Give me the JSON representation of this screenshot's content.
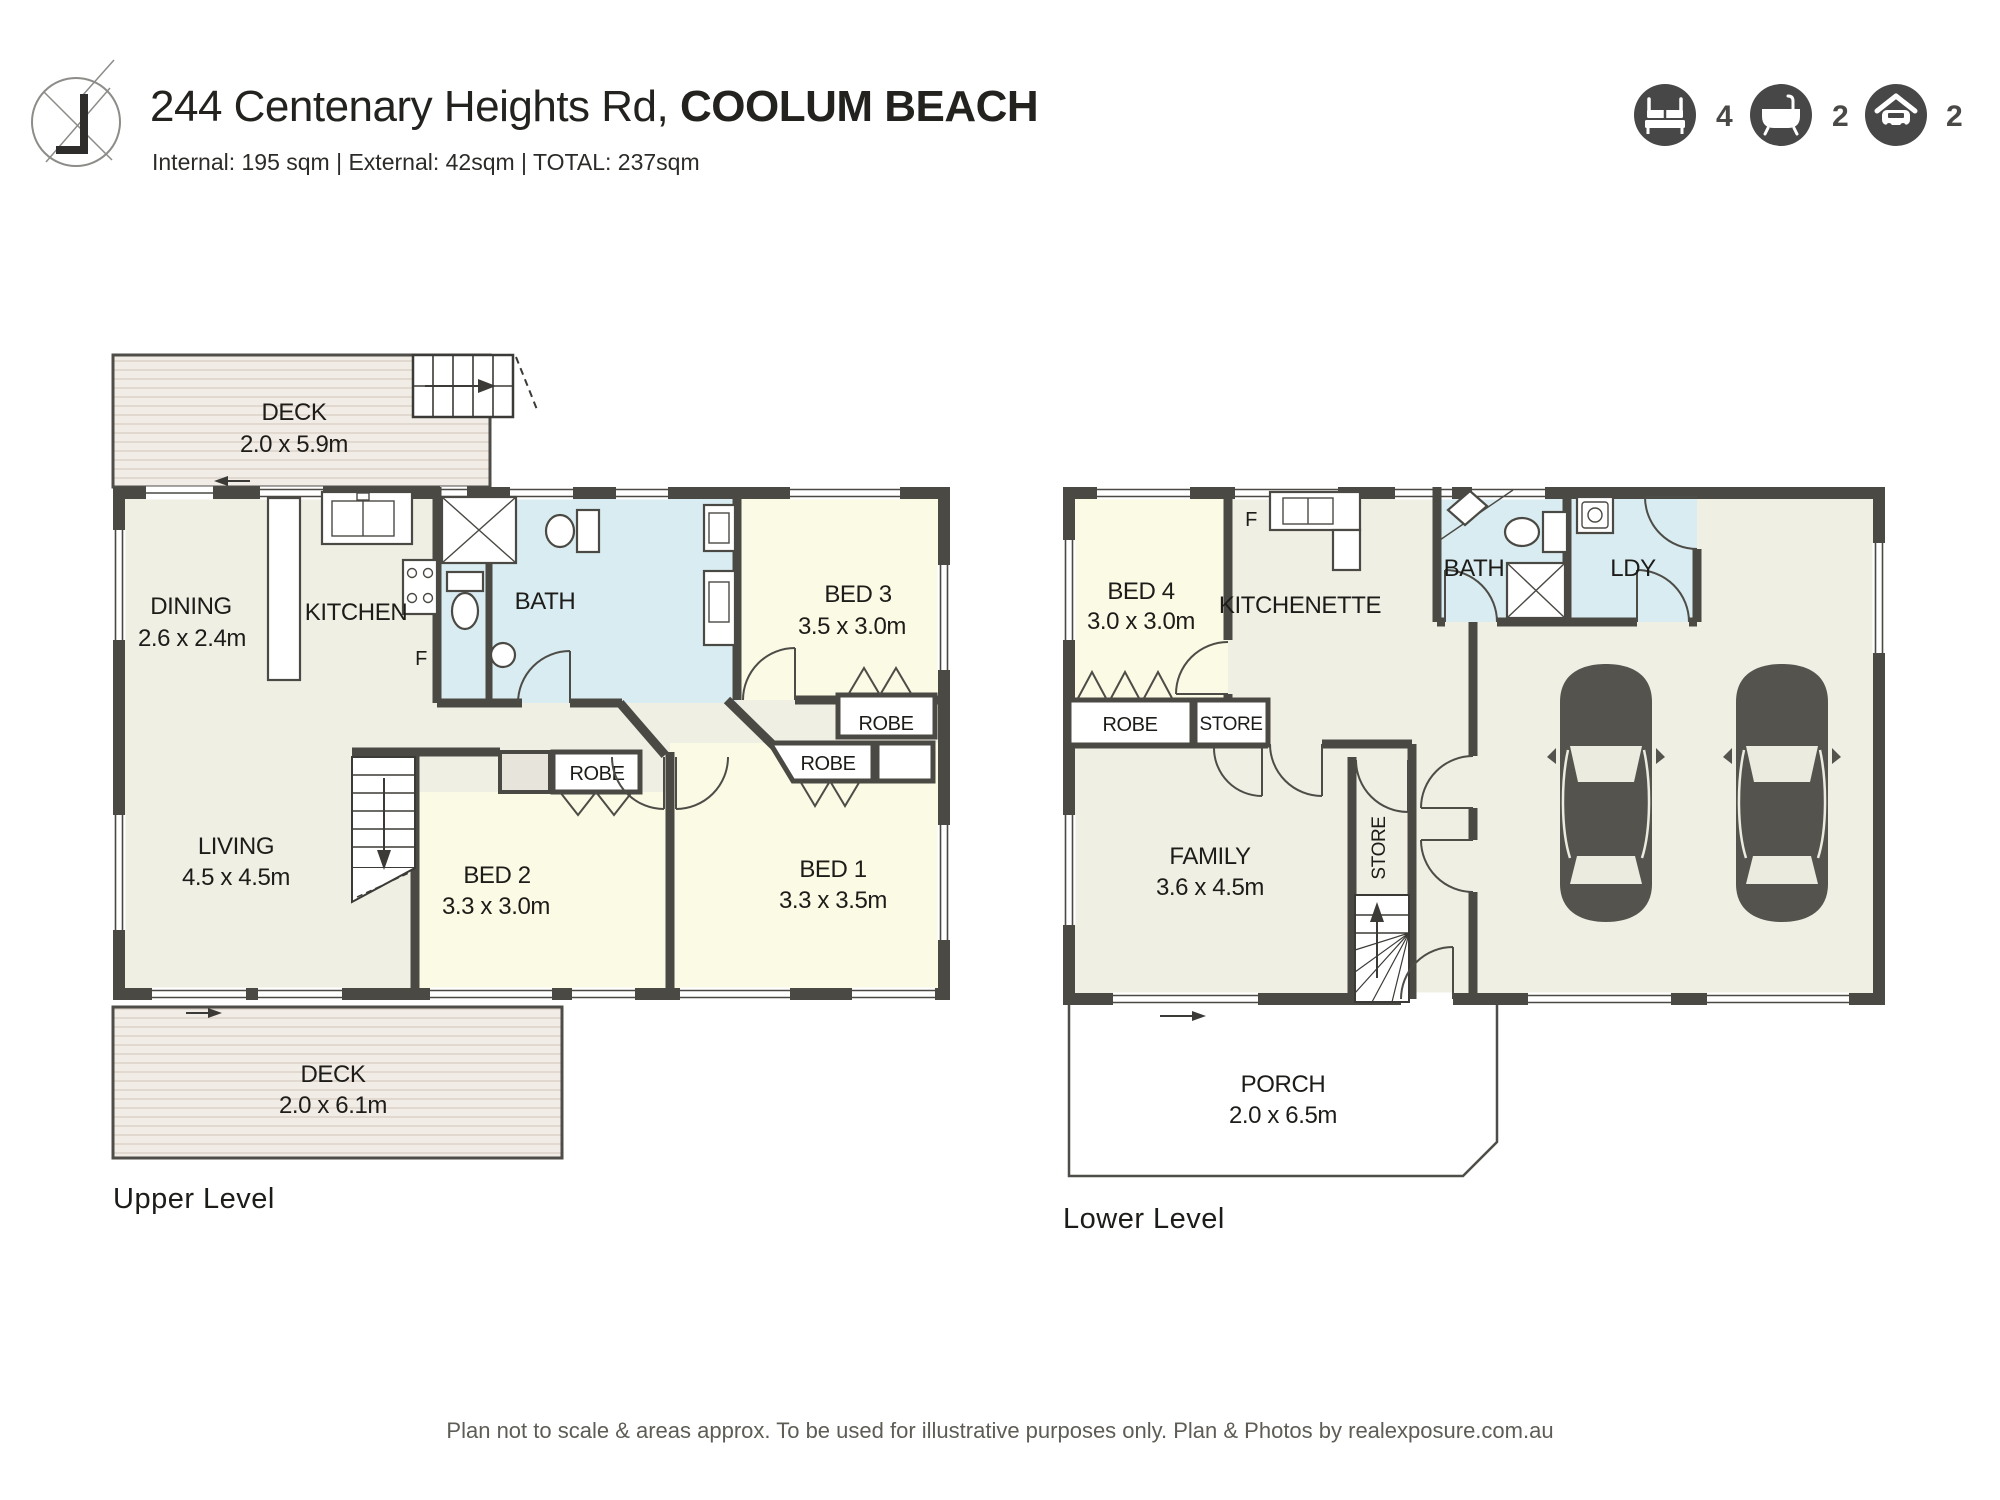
{
  "header": {
    "logo_icon": "realexposure-floorplan-logo",
    "address": {
      "street": "244 Centenary Heights Rd, ",
      "suburb": "COOLUM BEACH"
    },
    "areas_line": "Internal: 195 sqm  |  External: 42sqm  |  TOTAL: 237sqm",
    "stats": [
      {
        "icon": "bed-icon",
        "count": "4"
      },
      {
        "icon": "bath-icon",
        "count": "2"
      },
      {
        "icon": "car-garage-icon",
        "count": "2"
      }
    ]
  },
  "upper_level": {
    "label": "Upper Level",
    "deck_top": {
      "name": "DECK",
      "dims": "2.0 x 5.9m"
    },
    "dining": {
      "name": "DINING",
      "dims": "2.6 x 2.4m"
    },
    "kitchen": {
      "name": "KITCHEN"
    },
    "fridge_label": "F",
    "bath": {
      "name": "BATH"
    },
    "bed3": {
      "name": "BED 3",
      "dims": "3.5 x 3.0m"
    },
    "living": {
      "name": "LIVING",
      "dims": "4.5 x 4.5m"
    },
    "bed2": {
      "name": "BED 2",
      "dims": "3.3 x 3.0m"
    },
    "bed1": {
      "name": "BED 1",
      "dims": "3.3 x 3.5m"
    },
    "robe_bed3": "ROBE",
    "robe_bed2": "ROBE",
    "robe_bed1": "ROBE",
    "deck_bottom": {
      "name": "DECK",
      "dims": "2.0 x 6.1m"
    }
  },
  "lower_level": {
    "label": "Lower Level",
    "bed4": {
      "name": "BED 4",
      "dims": "3.0 x 3.0m"
    },
    "kitchenette": {
      "name": "KITCHENETTE"
    },
    "fridge_label": "F",
    "bath": {
      "name": "BATH"
    },
    "laundry": {
      "name": "LDY"
    },
    "robe_bed4": "ROBE",
    "store_top": "STORE",
    "store_mid": "STORE",
    "family": {
      "name": "FAMILY",
      "dims": "3.6 x 4.5m"
    },
    "porch": {
      "name": "PORCH",
      "dims": "2.0 x 6.5m"
    }
  },
  "footer": {
    "disclaimer": "Plan not to scale & areas approx. To be used for illustrative purposes only. Plan & Photos by realexposure.com.au"
  },
  "colors": {
    "wall": "#4b4944",
    "ink": "#1d1c19",
    "floor": "#f0efe4",
    "bedroom": "#fafae5",
    "wet": "#d9ecf1",
    "deck": "#f2ece6",
    "deckline": "#ddd3cb",
    "closet": "#e6e4db",
    "car": "#55534e",
    "stat": "#474747"
  }
}
